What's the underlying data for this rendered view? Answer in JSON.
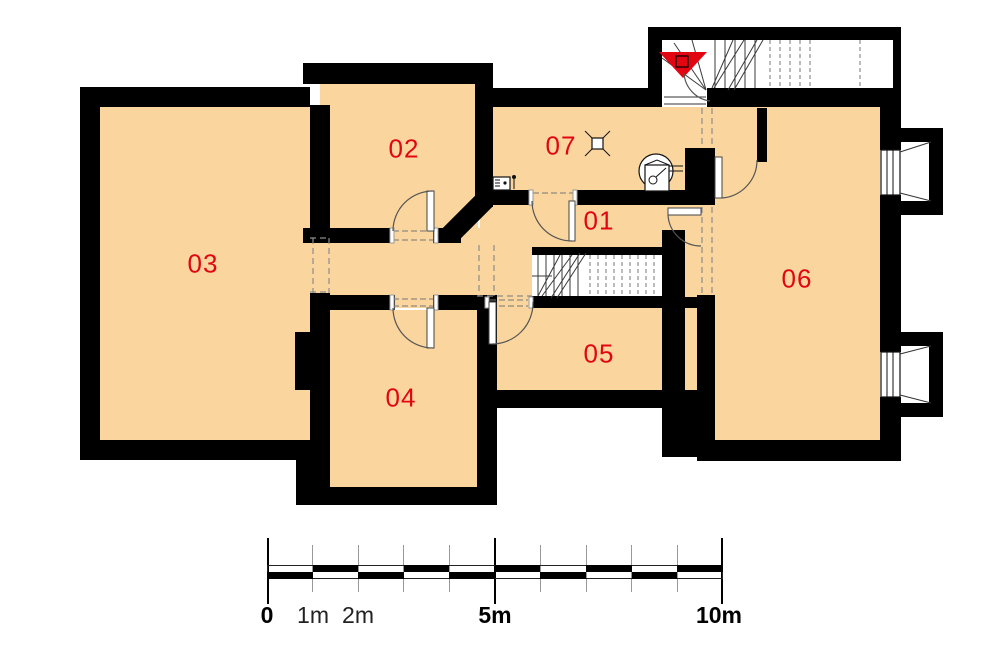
{
  "title": "Basement floor plan",
  "rooms": [
    {
      "label": "01"
    },
    {
      "label": "02"
    },
    {
      "label": "03"
    },
    {
      "label": "04"
    },
    {
      "label": "05"
    },
    {
      "label": "06"
    },
    {
      "label": "07"
    }
  ],
  "colors": {
    "floor": "#fad69e",
    "wall": "#000000",
    "room_label": "#e20613",
    "stair_arrow": "#e20613"
  },
  "scale_bar": {
    "labels": [
      {
        "text": "0"
      },
      {
        "text": "1m"
      },
      {
        "text": "2m"
      },
      {
        "text": "5m"
      },
      {
        "text": "10m"
      }
    ]
  },
  "icons": {
    "stairs_down_arrow": "red triangle pointing down at upper stair winder",
    "boiler": "circle with square heater symbol in room 07",
    "ceiling_light": "small square with corner rays in room 07",
    "gas_meter": "small meter box on wall of room 07",
    "window": "double-line window symbol in right wall",
    "door": "quarter-circle swing arc"
  }
}
